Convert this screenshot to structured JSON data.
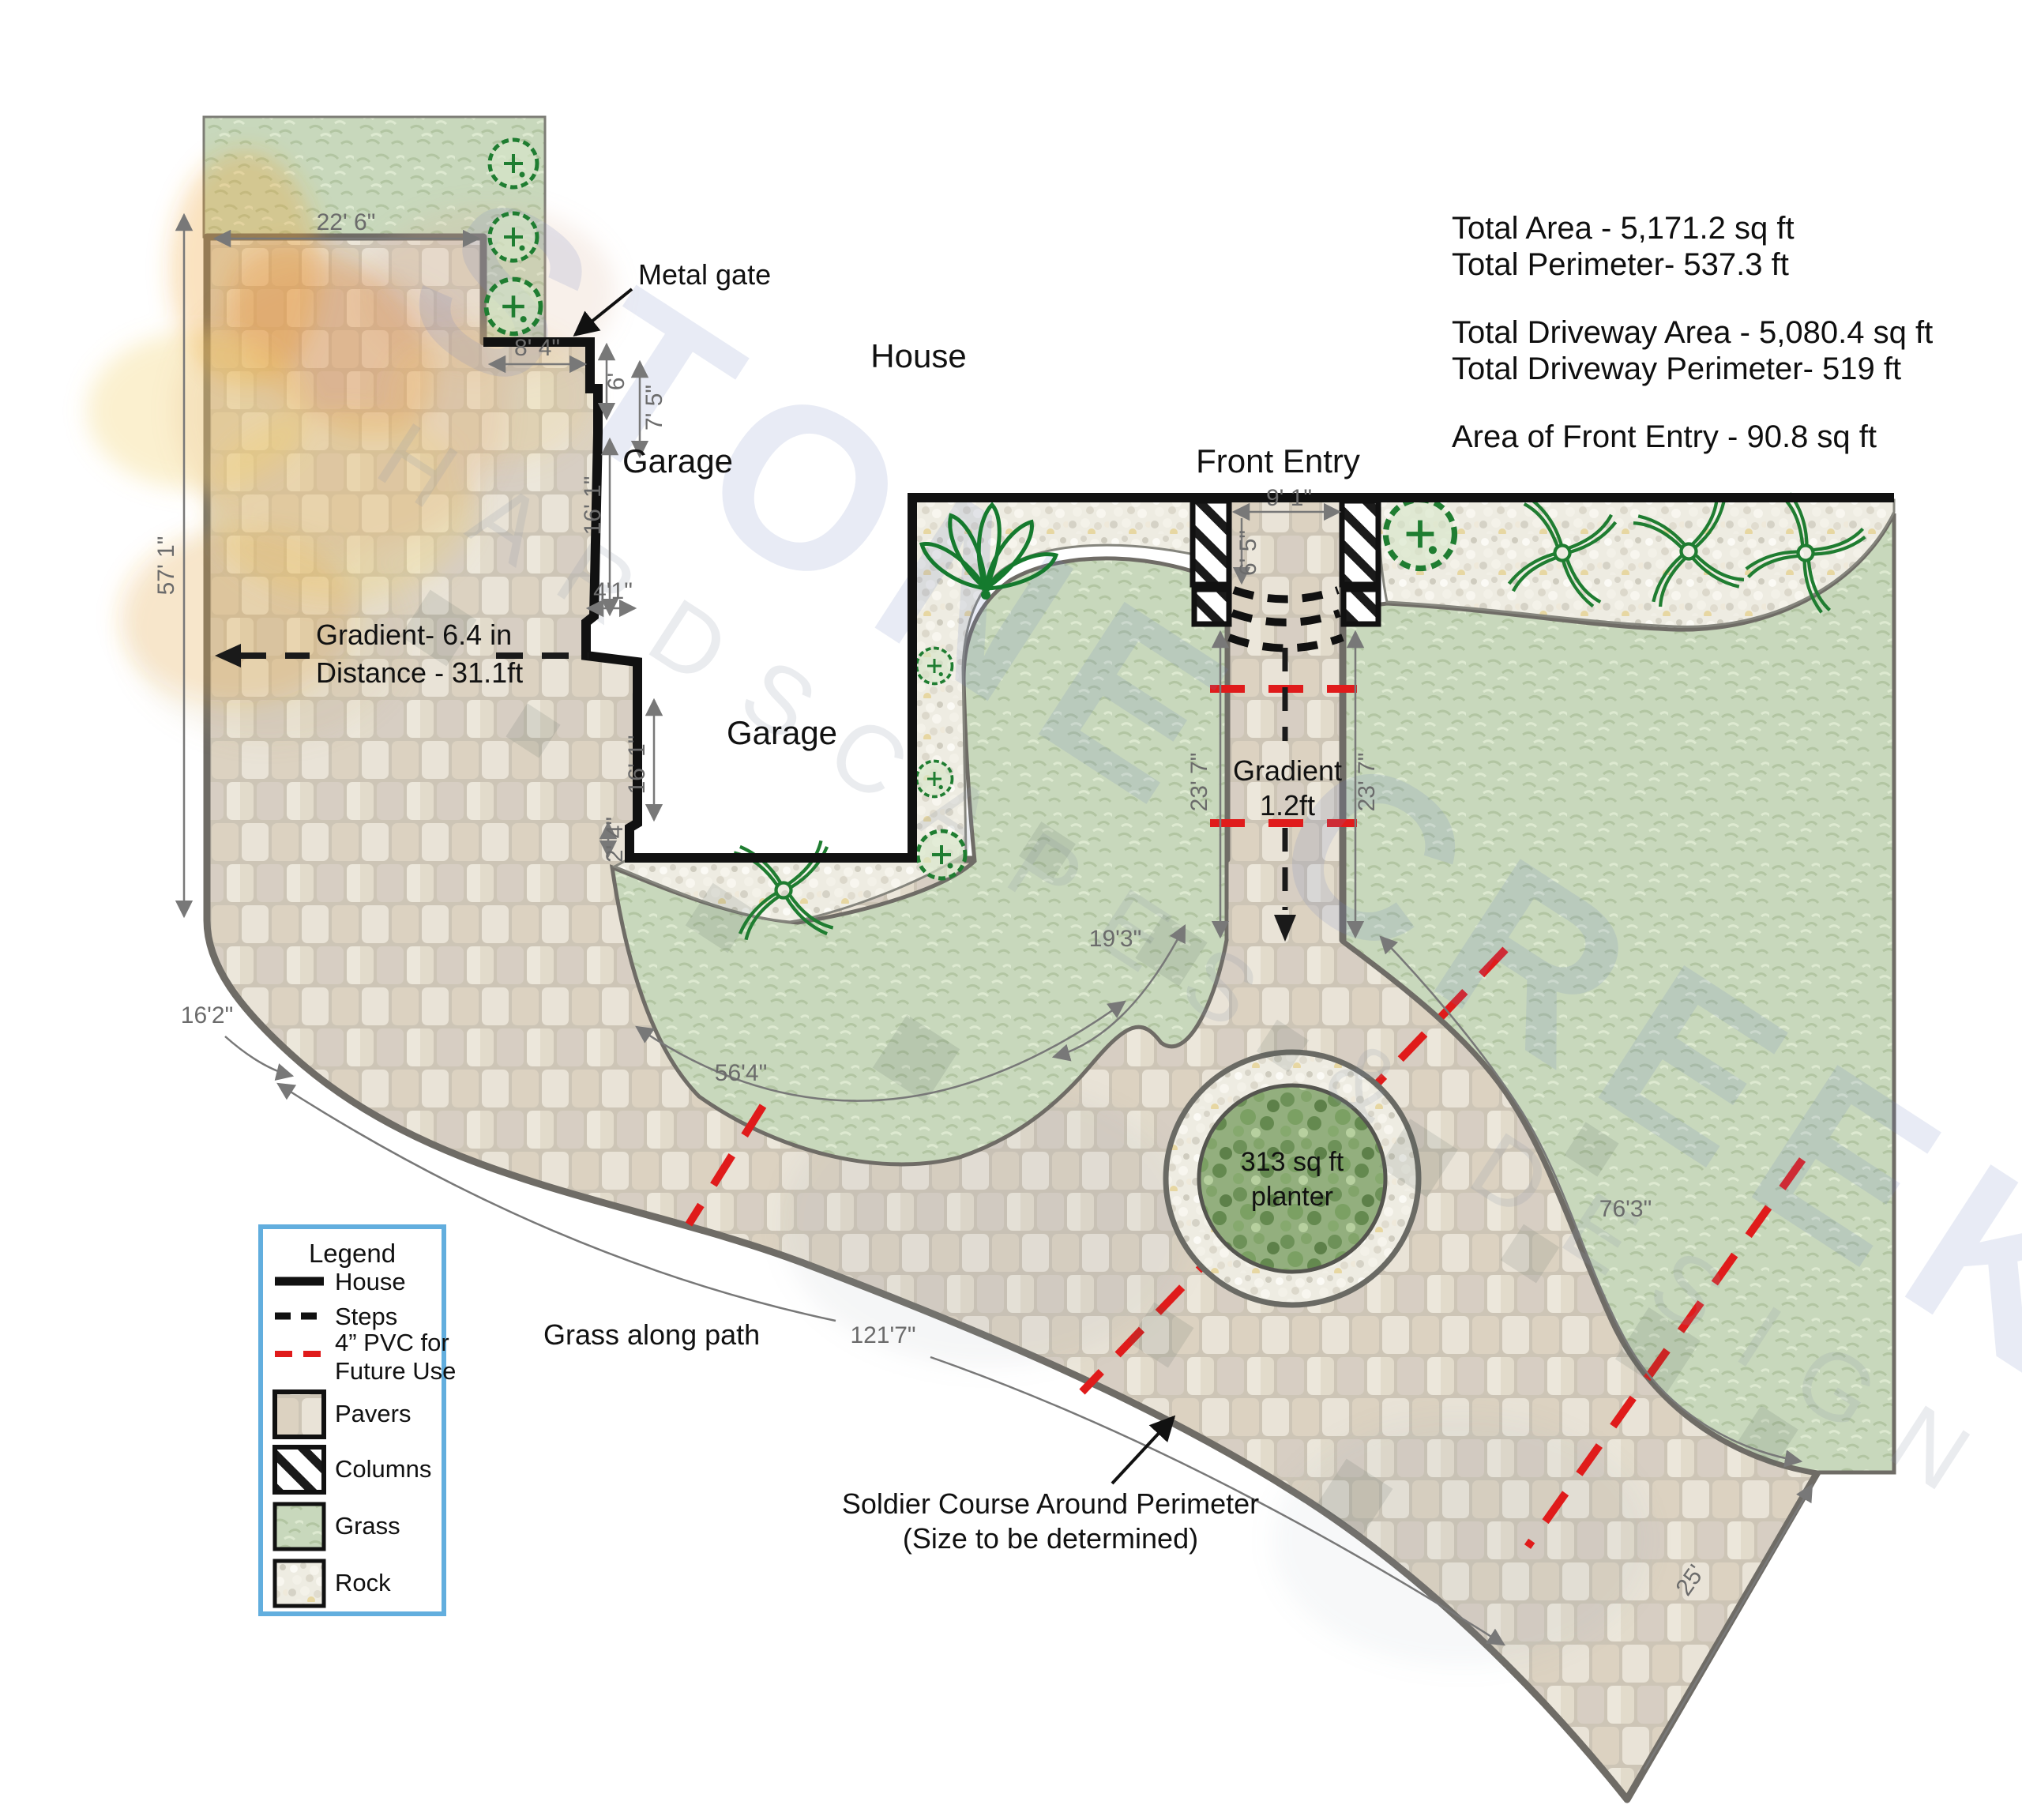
{
  "title": "Driveway hardscape design plan",
  "stats": {
    "total_area": "Total Area - 5,171.2 sq ft",
    "total_perimeter": "Total Perimeter- 537.3 ft",
    "driveway_area": "Total Driveway Area - 5,080.4 sq ft",
    "driveway_perimeter": "Total Driveway Perimeter- 519 ft",
    "front_entry_area": "Area of Front Entry - 90.8 sq ft"
  },
  "labels": {
    "house": "House",
    "garage_upper": "Garage",
    "garage_lower": "Garage",
    "front_entry": "Front Entry",
    "metal_gate": "Metal gate",
    "grass_along_path": "Grass along path",
    "planter_line1": "313 sq ft",
    "planter_line2": "planter",
    "soldier_line1": "Soldier Course Around Perimeter",
    "soldier_line2": "(Size to be determined)",
    "gradient_left_line1": "Gradient- 6.4 in",
    "gradient_left_line2": "Distance - 31.1ft",
    "gradient_entry_line1": "Gradient",
    "gradient_entry_line2": "1.2ft"
  },
  "dimensions": {
    "top_width": "22' 6\"",
    "gate_offset": "7' 5\"",
    "gate_width": "8' 4\"",
    "gate_depth": "6'",
    "garage_upper_side": "16' 1\"",
    "garage_step": "4'1\"",
    "garage_lower_side": "16' 1\"",
    "garage_corner": "2' 4\"",
    "left_height": "57' 1\"",
    "bottom_left_curve": "16'2\"",
    "island_curve": "56'4\"",
    "courtyard_mouth": "19'3\"",
    "walkway_left": "23' 7\"",
    "walkway_right": "23' 7\"",
    "entry_width": "9' 1\"",
    "entry_depth": "6' 5\"",
    "path_length": "121'7\"",
    "right_curve": "76'3\"",
    "bottom_right_edge": "25'"
  },
  "legend": {
    "title": "Legend",
    "items": [
      {
        "label": "House"
      },
      {
        "label": "Steps"
      },
      {
        "label": "4” PVC for",
        "label2": "Future Use"
      },
      {
        "label": "Pavers"
      },
      {
        "label": "Columns"
      },
      {
        "label": "Grass"
      },
      {
        "label": "Rock"
      }
    ]
  },
  "watermark": {
    "primary": "STONE CREEK",
    "secondary": "HARDSCAPES & DESIGN"
  },
  "colors": {
    "pvc_red": "#e01b1b",
    "plant_green": "#1c7c30",
    "legend_border": "#62aede",
    "dim_gray": "#6b6b6b",
    "wall_black": "#111111",
    "edge_gray": "#6f6c66"
  }
}
